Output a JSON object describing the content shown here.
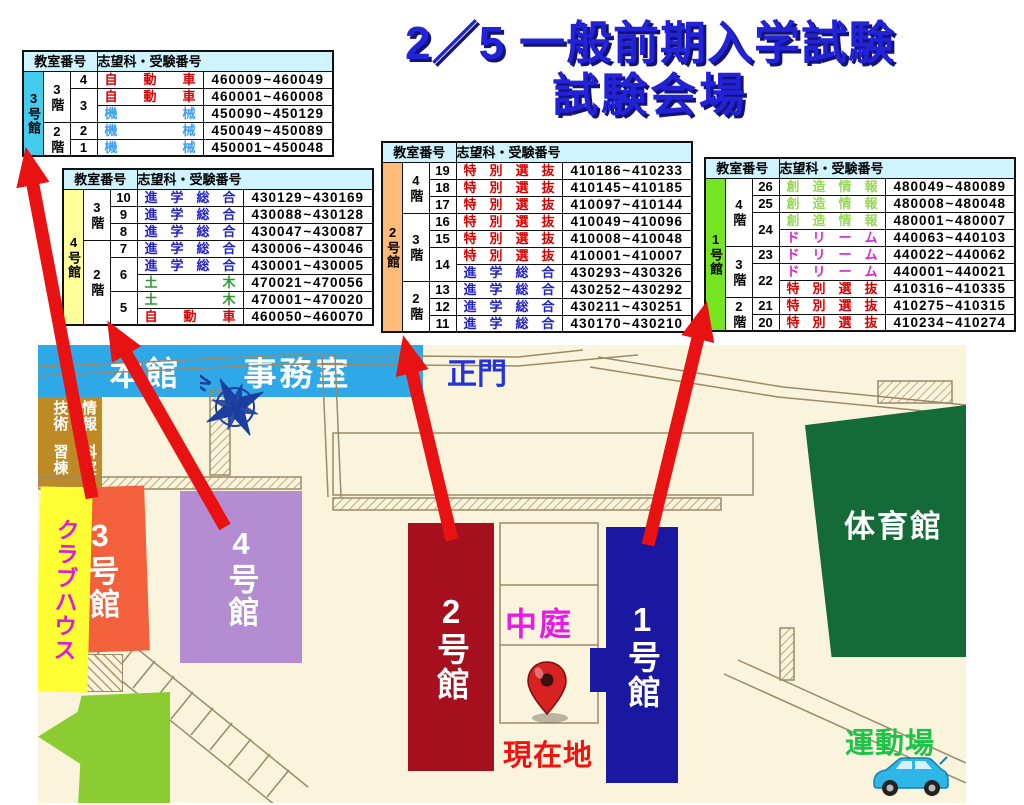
{
  "title": {
    "line1": "2／5 一般前期入学試験",
    "line2": "試験会場"
  },
  "table_header": {
    "rooms": "教室番号",
    "numbers": "志望科・受験番号"
  },
  "tilde": "~",
  "tables": [
    {
      "building": "3号館",
      "label_bg": "#44CCEE",
      "floors": [
        {
          "label": "3階",
          "span": 3
        },
        {
          "label": "2階",
          "span": 2
        }
      ],
      "rooms": [
        {
          "num": "4",
          "span": 1
        },
        {
          "num": "3",
          "span": 2
        },
        {
          "num": "2",
          "span": 1
        },
        {
          "num": "1",
          "span": 1
        }
      ],
      "rows": [
        {
          "subject": "自動車",
          "color": "#D90000",
          "start": "460009",
          "end": "460049"
        },
        {
          "subject": "自動車",
          "color": "#D90000",
          "start": "460001",
          "end": "460008"
        },
        {
          "subject": "機械",
          "color": "#3F9FEF",
          "start": "450090",
          "end": "450129"
        },
        {
          "subject": "機械",
          "color": "#3F9FEF",
          "start": "450049",
          "end": "450089"
        },
        {
          "subject": "機械",
          "color": "#3F9FEF",
          "start": "450001",
          "end": "450048"
        }
      ]
    },
    {
      "building": "4号館",
      "label_bg": "#FFFF99",
      "floors": [
        {
          "label": "3階",
          "span": 3
        },
        {
          "label": "2階",
          "span": 5
        }
      ],
      "rooms": [
        {
          "num": "10",
          "span": 1
        },
        {
          "num": "9",
          "span": 1
        },
        {
          "num": "8",
          "span": 1
        },
        {
          "num": "7",
          "span": 1
        },
        {
          "num": "6",
          "span": 2
        },
        {
          "num": "5",
          "span": 2
        }
      ],
      "rows": [
        {
          "subject": "進学総合",
          "color": "#2222CC",
          "start": "430129",
          "end": "430169"
        },
        {
          "subject": "進学総合",
          "color": "#2222CC",
          "start": "430088",
          "end": "430128"
        },
        {
          "subject": "進学総合",
          "color": "#2222CC",
          "start": "430047",
          "end": "430087"
        },
        {
          "subject": "進学総合",
          "color": "#2222CC",
          "start": "430006",
          "end": "430046"
        },
        {
          "subject": "進学総合",
          "color": "#2222CC",
          "start": "430001",
          "end": "430005"
        },
        {
          "subject": "土木",
          "color": "#2E9933",
          "start": "470021",
          "end": "470056"
        },
        {
          "subject": "土木",
          "color": "#2E9933",
          "start": "470001",
          "end": "470020"
        },
        {
          "subject": "自動車",
          "color": "#D90000",
          "start": "460050",
          "end": "460070"
        }
      ]
    },
    {
      "building": "2号館",
      "label_bg": "#FFBB77",
      "floors": [
        {
          "label": "4階",
          "span": 3
        },
        {
          "label": "3階",
          "span": 4
        },
        {
          "label": "2階",
          "span": 3
        }
      ],
      "rooms": [
        {
          "num": "19",
          "span": 1
        },
        {
          "num": "18",
          "span": 1
        },
        {
          "num": "17",
          "span": 1
        },
        {
          "num": "16",
          "span": 1
        },
        {
          "num": "15",
          "span": 1
        },
        {
          "num": "14",
          "span": 2
        },
        {
          "num": "13",
          "span": 1
        },
        {
          "num": "12",
          "span": 1
        },
        {
          "num": "11",
          "span": 1
        }
      ],
      "rows": [
        {
          "subject": "特別選抜",
          "color": "#D90000",
          "start": "410186",
          "end": "410233"
        },
        {
          "subject": "特別選抜",
          "color": "#D90000",
          "start": "410145",
          "end": "410185"
        },
        {
          "subject": "特別選抜",
          "color": "#D90000",
          "start": "410097",
          "end": "410144"
        },
        {
          "subject": "特別選抜",
          "color": "#D90000",
          "start": "410049",
          "end": "410096"
        },
        {
          "subject": "特別選抜",
          "color": "#D90000",
          "start": "410008",
          "end": "410048"
        },
        {
          "subject": "特別選抜",
          "color": "#D90000",
          "start": "410001",
          "end": "410007"
        },
        {
          "subject": "進学総合",
          "color": "#2222CC",
          "start": "430293",
          "end": "430326"
        },
        {
          "subject": "進学総合",
          "color": "#2222CC",
          "start": "430252",
          "end": "430292"
        },
        {
          "subject": "進学総合",
          "color": "#2222CC",
          "start": "430211",
          "end": "430251"
        },
        {
          "subject": "進学総合",
          "color": "#2222CC",
          "start": "430170",
          "end": "430210"
        }
      ]
    },
    {
      "building": "1号館",
      "label_bg": "#77E622",
      "floors": [
        {
          "label": "4階",
          "span": 4
        },
        {
          "label": "3階",
          "span": 3
        },
        {
          "label": "2階",
          "span": 2
        }
      ],
      "rooms": [
        {
          "num": "26",
          "span": 1
        },
        {
          "num": "25",
          "span": 1
        },
        {
          "num": "24",
          "span": 2
        },
        {
          "num": "23",
          "span": 1
        },
        {
          "num": "22",
          "span": 2
        },
        {
          "num": "21",
          "span": 1
        },
        {
          "num": "20",
          "span": 1
        }
      ],
      "rows": [
        {
          "subject": "創造情報",
          "color": "#97D855",
          "start": "480049",
          "end": "480089"
        },
        {
          "subject": "創造情報",
          "color": "#97D855",
          "start": "480008",
          "end": "480048"
        },
        {
          "subject": "創造情報",
          "color": "#97D855",
          "start": "480001",
          "end": "480007"
        },
        {
          "subject": "ドリーム",
          "color": "#DD22CC",
          "start": "440063",
          "end": "440103"
        },
        {
          "subject": "ドリーム",
          "color": "#DD22CC",
          "start": "440022",
          "end": "440062"
        },
        {
          "subject": "ドリーム",
          "color": "#DD22CC",
          "start": "440001",
          "end": "440021"
        },
        {
          "subject": "特別選抜",
          "color": "#D90000",
          "start": "410316",
          "end": "410335"
        },
        {
          "subject": "特別選抜",
          "color": "#D90000",
          "start": "410275",
          "end": "410315"
        },
        {
          "subject": "特別選抜",
          "color": "#D90000",
          "start": "410234",
          "end": "410274"
        }
      ]
    }
  ],
  "map": {
    "labels": {
      "main_gate": "正門",
      "courtyard": "中庭",
      "current_location": "現在地",
      "sports_ground": "運動場",
      "north": "N"
    },
    "buildings": {
      "main_hall": "本館",
      "office": "事務室",
      "bldg3": "3号館",
      "bldg4": "4号館",
      "bldg2": "2号館",
      "bldg1": "1号館",
      "gym": "体育館",
      "clubhouse": "クラブハウス",
      "it_lab_col1": "情報技術",
      "it_lab_col2": "科実習棟",
      "cafe_line1": "You",
      "cafe_line2": "Cafe"
    },
    "colors": {
      "map_background": "#FAF4DC",
      "arrow_red": "#E81212",
      "bldg3": "#F2613B",
      "bldg4": "#B48CD2",
      "bldg2": "#A6101E",
      "bldg1": "#1A18A0",
      "main_hall": "#2FA8E8",
      "gym": "#156B38",
      "clubhouse": "#FFFF33",
      "it_lab": "#BE8A26",
      "you_cafe": "#8CCC33",
      "title_blue": "#2222D6"
    }
  }
}
